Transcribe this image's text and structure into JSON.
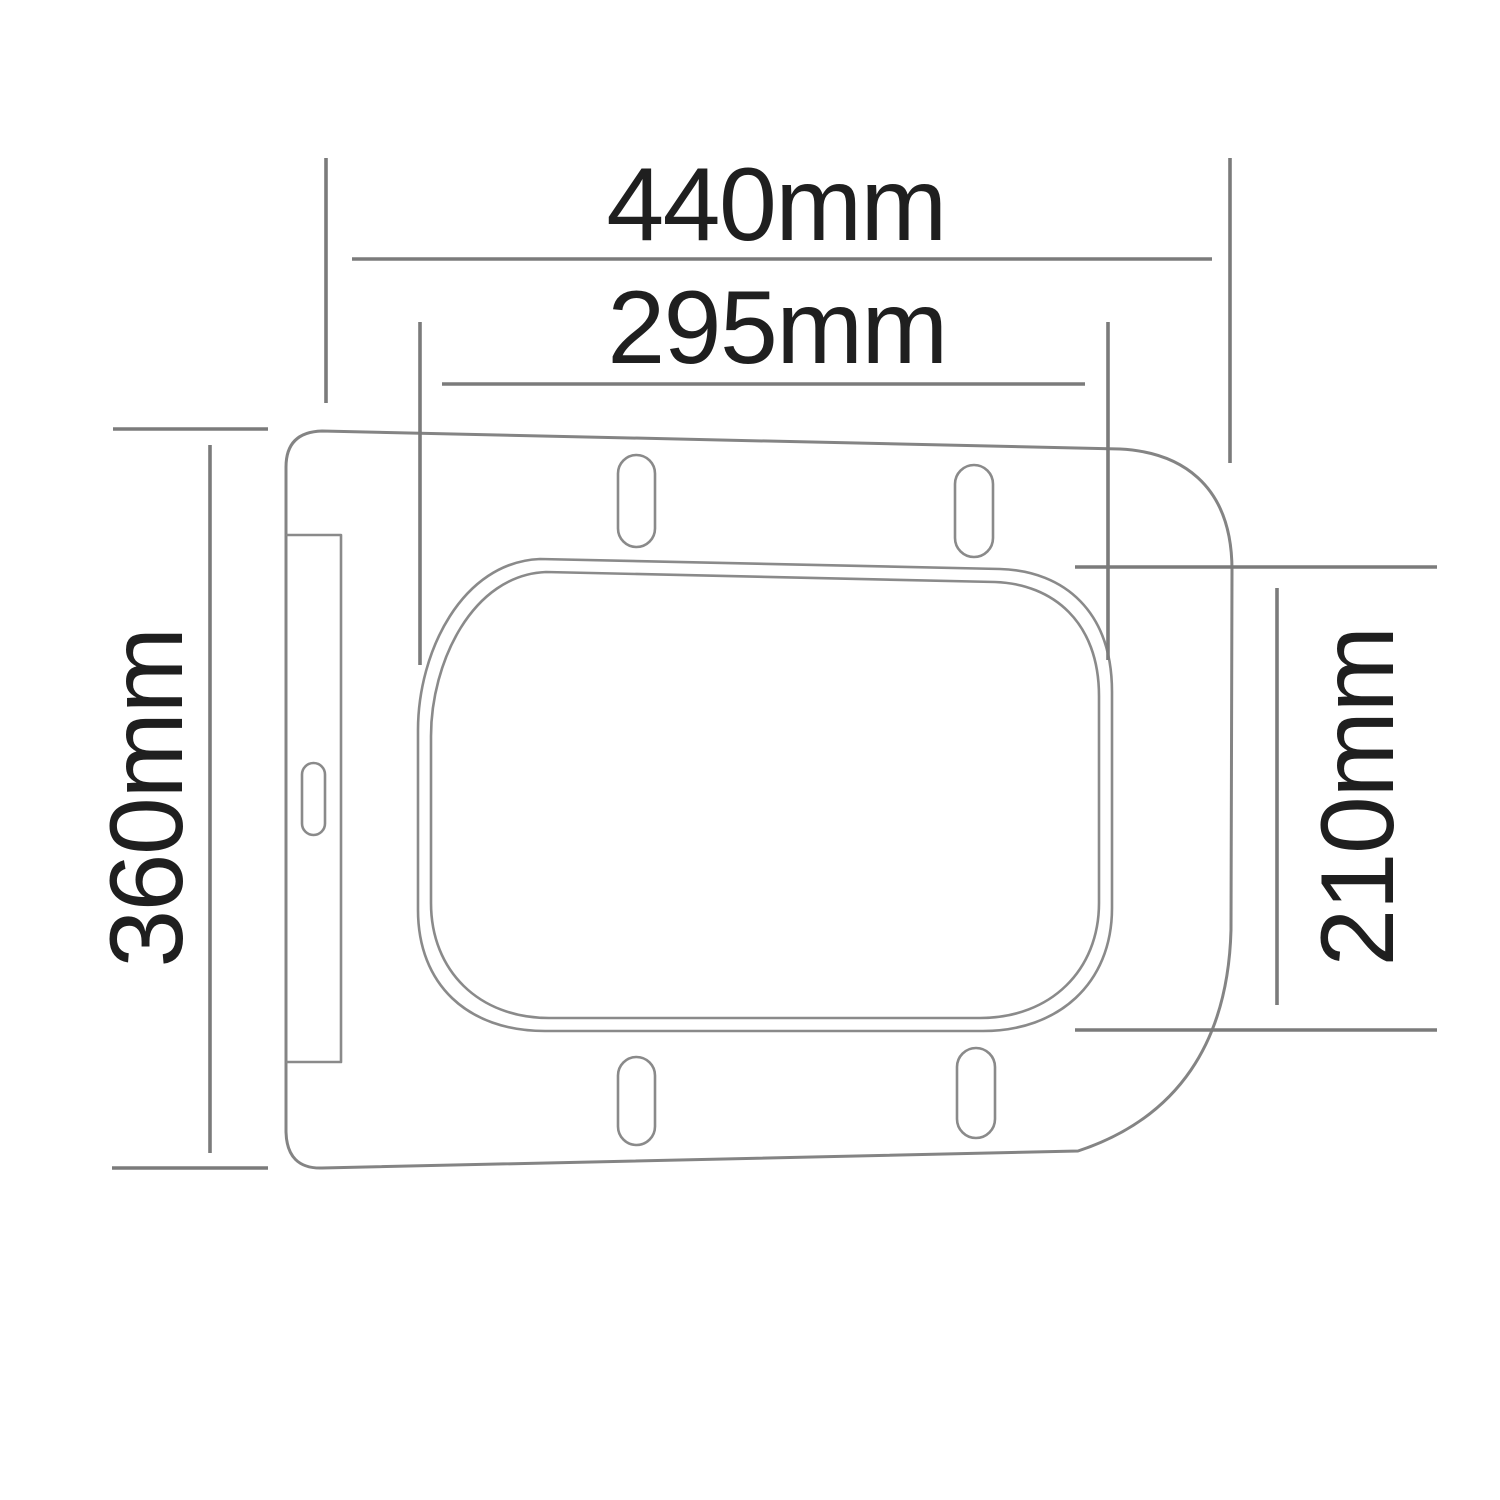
{
  "diagram": {
    "type": "technical-drawing",
    "subject": "toilet-seat-top-view-with-dimensions",
    "unit": "mm",
    "dimensions": {
      "overall_width": {
        "label": "440mm",
        "value": 440,
        "orientation": "horizontal",
        "measures": "outer width of seat"
      },
      "inner_width": {
        "label": "295mm",
        "value": 295,
        "orientation": "horizontal",
        "measures": "width of seat opening"
      },
      "overall_depth": {
        "label": "360mm",
        "value": 360,
        "orientation": "vertical",
        "measures": "outer depth of seat"
      },
      "inner_depth": {
        "label": "210mm",
        "value": 210,
        "orientation": "vertical",
        "measures": "depth of seat opening"
      }
    },
    "features": {
      "mounting_slots_count": 4,
      "hinge_plate_slot_count": 1
    },
    "colors": {
      "background": "#ffffff",
      "outline": "#848484",
      "dimension_line": "#7b7b7b",
      "text": "#1f1f1f"
    }
  }
}
